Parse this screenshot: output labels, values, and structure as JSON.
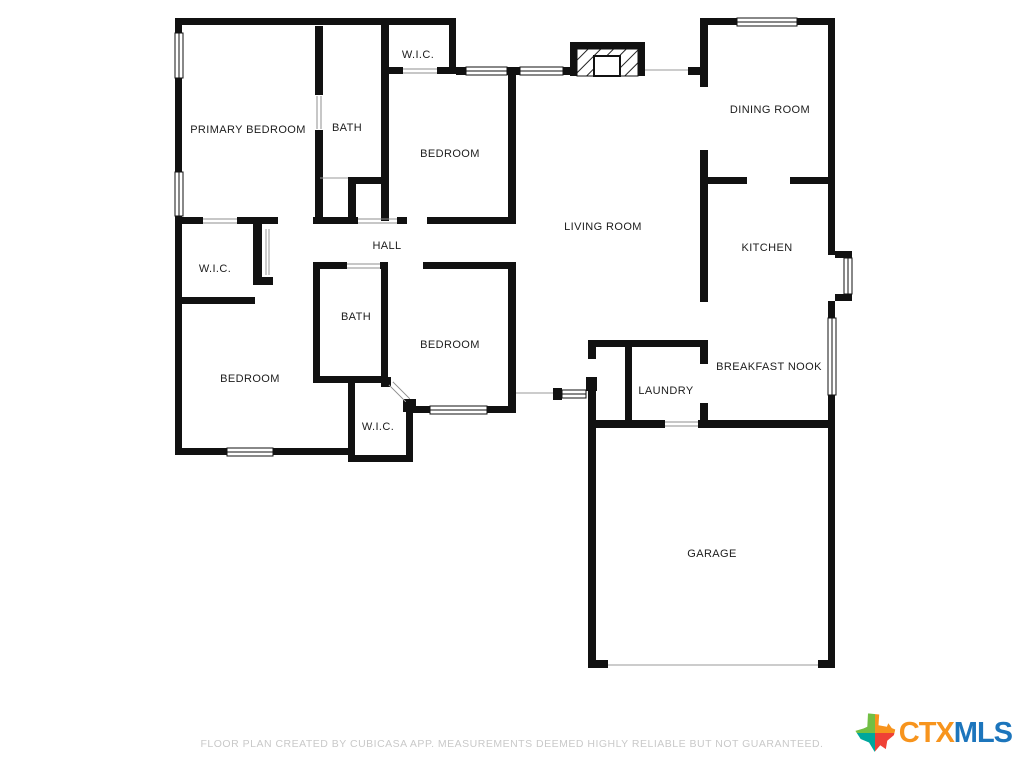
{
  "floor_plan": {
    "rooms": [
      {
        "name": "PRIMARY BEDROOM",
        "x": 248,
        "y": 130
      },
      {
        "name": "BATH",
        "x": 347,
        "y": 128
      },
      {
        "name": "W.I.C.",
        "x": 418,
        "y": 55
      },
      {
        "name": "BEDROOM",
        "x": 450,
        "y": 154
      },
      {
        "name": "DINING ROOM",
        "x": 770,
        "y": 110
      },
      {
        "name": "LIVING ROOM",
        "x": 603,
        "y": 227
      },
      {
        "name": "HALL",
        "x": 387,
        "y": 246
      },
      {
        "name": "KITCHEN",
        "x": 767,
        "y": 248
      },
      {
        "name": "W.I.C.",
        "x": 215,
        "y": 269
      },
      {
        "name": "BATH",
        "x": 356,
        "y": 317
      },
      {
        "name": "BEDROOM",
        "x": 450,
        "y": 345
      },
      {
        "name": "BREAKFAST NOOK",
        "x": 769,
        "y": 367
      },
      {
        "name": "BEDROOM",
        "x": 250,
        "y": 379
      },
      {
        "name": "LAUNDRY",
        "x": 666,
        "y": 391
      },
      {
        "name": "W.I.C.",
        "x": 378,
        "y": 427
      },
      {
        "name": "GARAGE",
        "x": 712,
        "y": 554
      }
    ]
  },
  "footer": {
    "disclaimer": "FLOOR PLAN CREATED BY CUBICASA APP. MEASUREMENTS DEEMED HIGHLY RELIABLE BUT NOT GUARANTEED."
  },
  "logo": {
    "prefix": "CTX",
    "suffix": "MLS",
    "prefix_color": "#F7941D",
    "suffix_color": "#1C75BC",
    "icon": "texas-state-icon",
    "icon_colors": {
      "top_left": "#72BF44",
      "top_right": "#F7941D",
      "bottom_left": "#00A79D",
      "bottom_right": "#EF4136"
    }
  }
}
